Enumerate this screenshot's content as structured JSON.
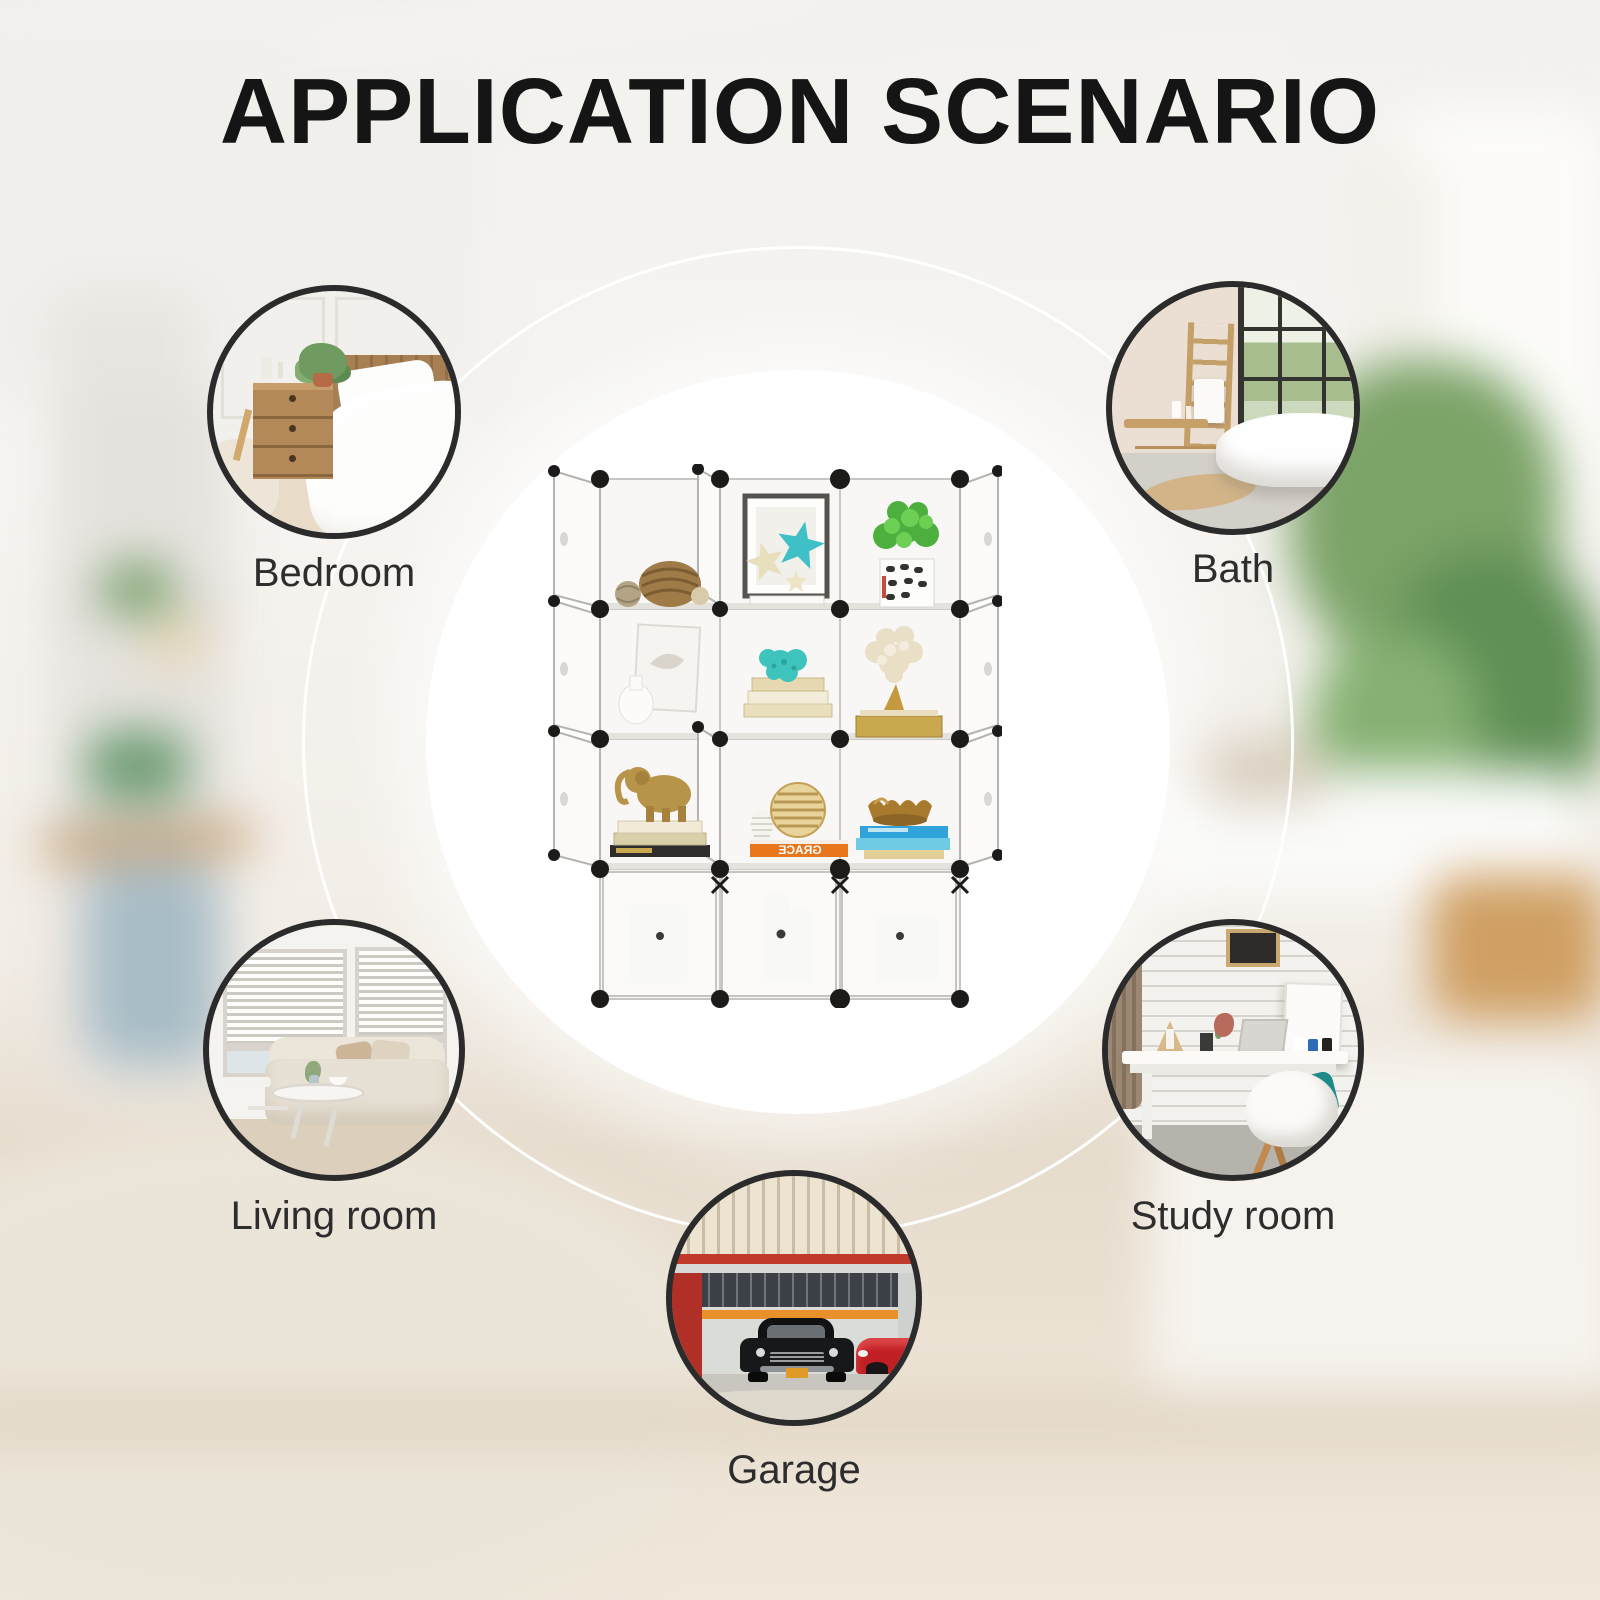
{
  "title": "APPLICATION SCENARIO",
  "scenarios": [
    {
      "id": "bedroom",
      "label": "Bedroom"
    },
    {
      "id": "bath",
      "label": "Bath"
    },
    {
      "id": "living-room",
      "label": "Living room"
    },
    {
      "id": "study-room",
      "label": "Study room"
    },
    {
      "id": "garage",
      "label": "Garage"
    }
  ],
  "product": {
    "kind": "12-cube modular storage organizer",
    "book_spine_text": "GRACE"
  },
  "colors": {
    "title_text": "#151515",
    "label_text": "#2d2d2d",
    "circle_border": "#2b2b2b",
    "orbit_ring": "#ffffff",
    "center_disc": "#ffffff",
    "connector": "#1c1b1a",
    "orange_book": "#e8761d",
    "teal_accent": "#3fbfc6"
  }
}
